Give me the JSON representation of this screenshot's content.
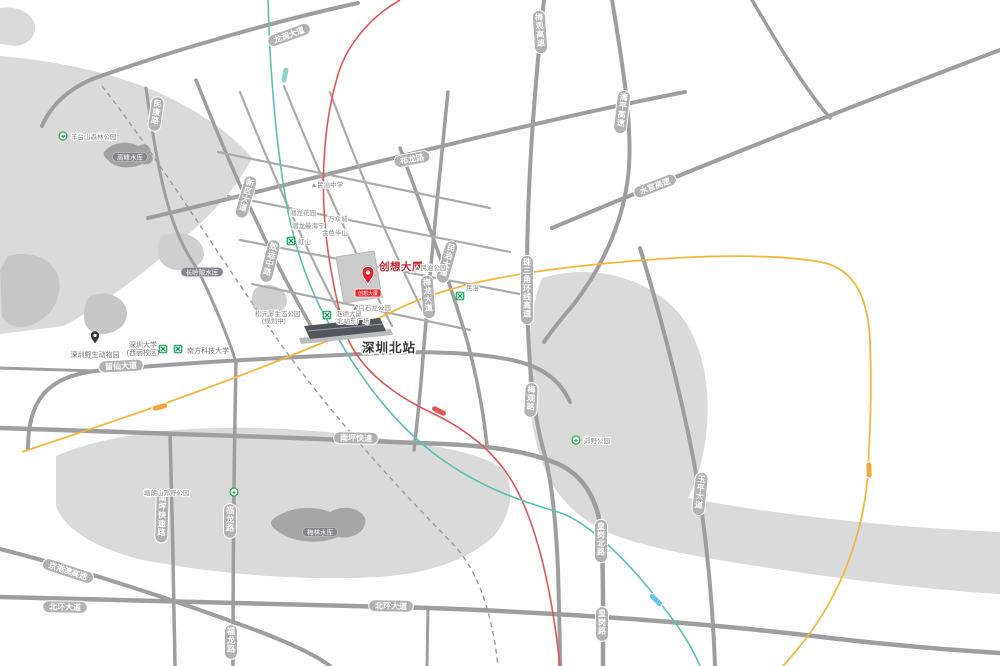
{
  "map": {
    "width": 1000,
    "height": 666,
    "background": "#ffffff"
  },
  "colors": {
    "road": "#9e9e9e",
    "road_minor": "#ababab",
    "capsule_fill": "#b2b2b2",
    "capsule_text": "#ffffff",
    "area_gray": "#dadada",
    "area_dark": "#c6c6c6",
    "water_gray": "#a2a2a2",
    "water_capsule": "#83888d",
    "metro_green": "#009b4c",
    "park_green": "#2fa84f",
    "rail_red": "#e0565a",
    "line_teal": "#5bbfb5",
    "line_yellow": "#f3b73d",
    "badge_orange": "#f0a63a",
    "badge_blue": "#6cc4e8",
    "project_red": "#e3242b",
    "project_text_red": "#c2262e",
    "station_text": "#333333",
    "poi_text": "#8a8a8a"
  },
  "project": {
    "name": "创想大厦",
    "label_x": 379,
    "label_y": 270,
    "pin_x": 368,
    "pin_y": 284,
    "badge_text": "创想大厦",
    "badge_x": 368,
    "badge_y": 290
  },
  "station": {
    "name": "深圳北站",
    "label_x": 362,
    "label_y": 352
  },
  "road_labels": [
    {
      "text": "龙澜大道",
      "x": 289,
      "y": 35,
      "angle": -20,
      "orient": "h"
    },
    {
      "text": "布龙路",
      "x": 412,
      "y": 159,
      "angle": -11,
      "orient": "h"
    },
    {
      "text": "清平高速",
      "x": 622,
      "y": 112,
      "angle": 7,
      "orient": "v"
    },
    {
      "text": "水官高速",
      "x": 655,
      "y": 186,
      "angle": -21,
      "orient": "h"
    },
    {
      "text": "珠三角环线高速",
      "x": 527,
      "y": 290,
      "angle": 0,
      "orient": "v"
    },
    {
      "text": "梅观高速",
      "x": 540,
      "y": 32,
      "angle": -4,
      "orient": "v"
    },
    {
      "text": "梅观路",
      "x": 531,
      "y": 400,
      "angle": 3,
      "orient": "v"
    },
    {
      "text": "南坪快速",
      "x": 356,
      "y": 438,
      "angle": 1,
      "orient": "h"
    },
    {
      "text": "北环大道",
      "x": 391,
      "y": 606,
      "angle": 1,
      "orient": "h"
    },
    {
      "text": "北环大道",
      "x": 65,
      "y": 607,
      "angle": 1,
      "orient": "h"
    },
    {
      "text": "京港澳高速",
      "x": 68,
      "y": 571,
      "angle": 18,
      "orient": "h"
    },
    {
      "text": "留仙大道",
      "x": 121,
      "y": 366,
      "angle": -3,
      "orient": "h"
    },
    {
      "text": "南坪快速路",
      "x": 162,
      "y": 517,
      "angle": 2,
      "orient": "v"
    },
    {
      "text": "福龙路",
      "x": 230,
      "y": 521,
      "angle": 0,
      "orient": "v"
    },
    {
      "text": "福龙路",
      "x": 231,
      "y": 642,
      "angle": 0,
      "orient": "v"
    },
    {
      "text": "玉平大道",
      "x": 700,
      "y": 494,
      "angle": 6,
      "orient": "v"
    },
    {
      "text": "皇岗北路",
      "x": 601,
      "y": 541,
      "angle": 0,
      "orient": "v"
    },
    {
      "text": "皇岗路",
      "x": 602,
      "y": 624,
      "angle": 0,
      "orient": "v"
    },
    {
      "text": "民治大道",
      "x": 447,
      "y": 262,
      "angle": 16,
      "orient": "v"
    },
    {
      "text": "梅龙大道",
      "x": 428,
      "y": 297,
      "angle": -4,
      "orient": "v"
    },
    {
      "text": "新区大道",
      "x": 246,
      "y": 197,
      "angle": 16,
      "orient": "v"
    },
    {
      "text": "民康路",
      "x": 156,
      "y": 114,
      "angle": 8,
      "orient": "v"
    },
    {
      "text": "致远中路",
      "x": 270,
      "y": 261,
      "angle": 14,
      "orient": "v"
    }
  ],
  "water_labels": [
    {
      "text": "高峰水库",
      "x": 130,
      "y": 157
    },
    {
      "text": "长岭陂水库",
      "x": 202,
      "y": 272
    },
    {
      "text": "梅林水库",
      "x": 320,
      "y": 532
    }
  ],
  "pois": [
    {
      "text": "▲民治中学",
      "x": 327,
      "y": 187,
      "anchor": "middle"
    },
    {
      "text": "▲民治公园",
      "x": 414,
      "y": 270,
      "anchor": "start"
    },
    {
      "text": "▲白石龙公园",
      "x": 352,
      "y": 310,
      "anchor": "start"
    },
    {
      "text": "松元厦生态公园",
      "x": 255,
      "y": 316,
      "anchor": "start"
    },
    {
      "text": "(规划中)",
      "x": 262,
      "y": 323,
      "anchor": "start"
    },
    {
      "text": "潜龙花园",
      "x": 290,
      "y": 215,
      "anchor": "start"
    },
    {
      "text": "万众城",
      "x": 328,
      "y": 221,
      "anchor": "start"
    },
    {
      "text": "潜龙曼海宁",
      "x": 292,
      "y": 228,
      "anchor": "start"
    },
    {
      "text": "金色半山",
      "x": 322,
      "y": 235,
      "anchor": "start"
    },
    {
      "text": "汇德大厦",
      "x": 336,
      "y": 316,
      "anchor": "start"
    },
    {
      "text": "北站东广场",
      "x": 337,
      "y": 323,
      "anchor": "start"
    },
    {
      "text": "红山",
      "x": 298,
      "y": 244,
      "anchor": "start"
    },
    {
      "text": "民治",
      "x": 466,
      "y": 290,
      "anchor": "start"
    }
  ],
  "places": [
    {
      "text": "深圳大学",
      "x": 143,
      "y": 347,
      "anchor": "middle"
    },
    {
      "text": "(西丽校区)",
      "x": 143,
      "y": 355,
      "anchor": "middle"
    },
    {
      "text": "南方科技大学",
      "x": 187,
      "y": 353,
      "anchor": "start"
    },
    {
      "text": "深圳野生动物园",
      "x": 95,
      "y": 357,
      "anchor": "middle"
    }
  ],
  "parks": [
    {
      "text": "羊台山森林公园",
      "icon_x": 63,
      "icon_y": 136,
      "text_x": 71,
      "text_y": 139
    },
    {
      "text": "塘朗山郊野公园",
      "icon_x": 234,
      "icon_y": 492,
      "text_x": 144,
      "text_y": 495
    },
    {
      "text": "郊野公园",
      "icon_x": 576,
      "icon_y": 440,
      "text_x": 584,
      "text_y": 443
    }
  ],
  "metro_icons": [
    {
      "x": 291,
      "y": 241
    },
    {
      "x": 327,
      "y": 315
    },
    {
      "x": 460,
      "y": 296
    },
    {
      "x": 163,
      "y": 349
    },
    {
      "x": 178,
      "y": 349
    }
  ],
  "line_badges": [
    {
      "x": 285,
      "y": 75,
      "angle": -80,
      "color": "#8fd0cd"
    },
    {
      "x": 160,
      "y": 407,
      "angle": -15,
      "color": "#f0a63a"
    },
    {
      "x": 439,
      "y": 411,
      "angle": 27,
      "color": "#e0565a"
    },
    {
      "x": 869,
      "y": 470,
      "angle": 88,
      "color": "#f0a63a"
    },
    {
      "x": 656,
      "y": 600,
      "angle": 45,
      "color": "#6cc4e8"
    }
  ]
}
